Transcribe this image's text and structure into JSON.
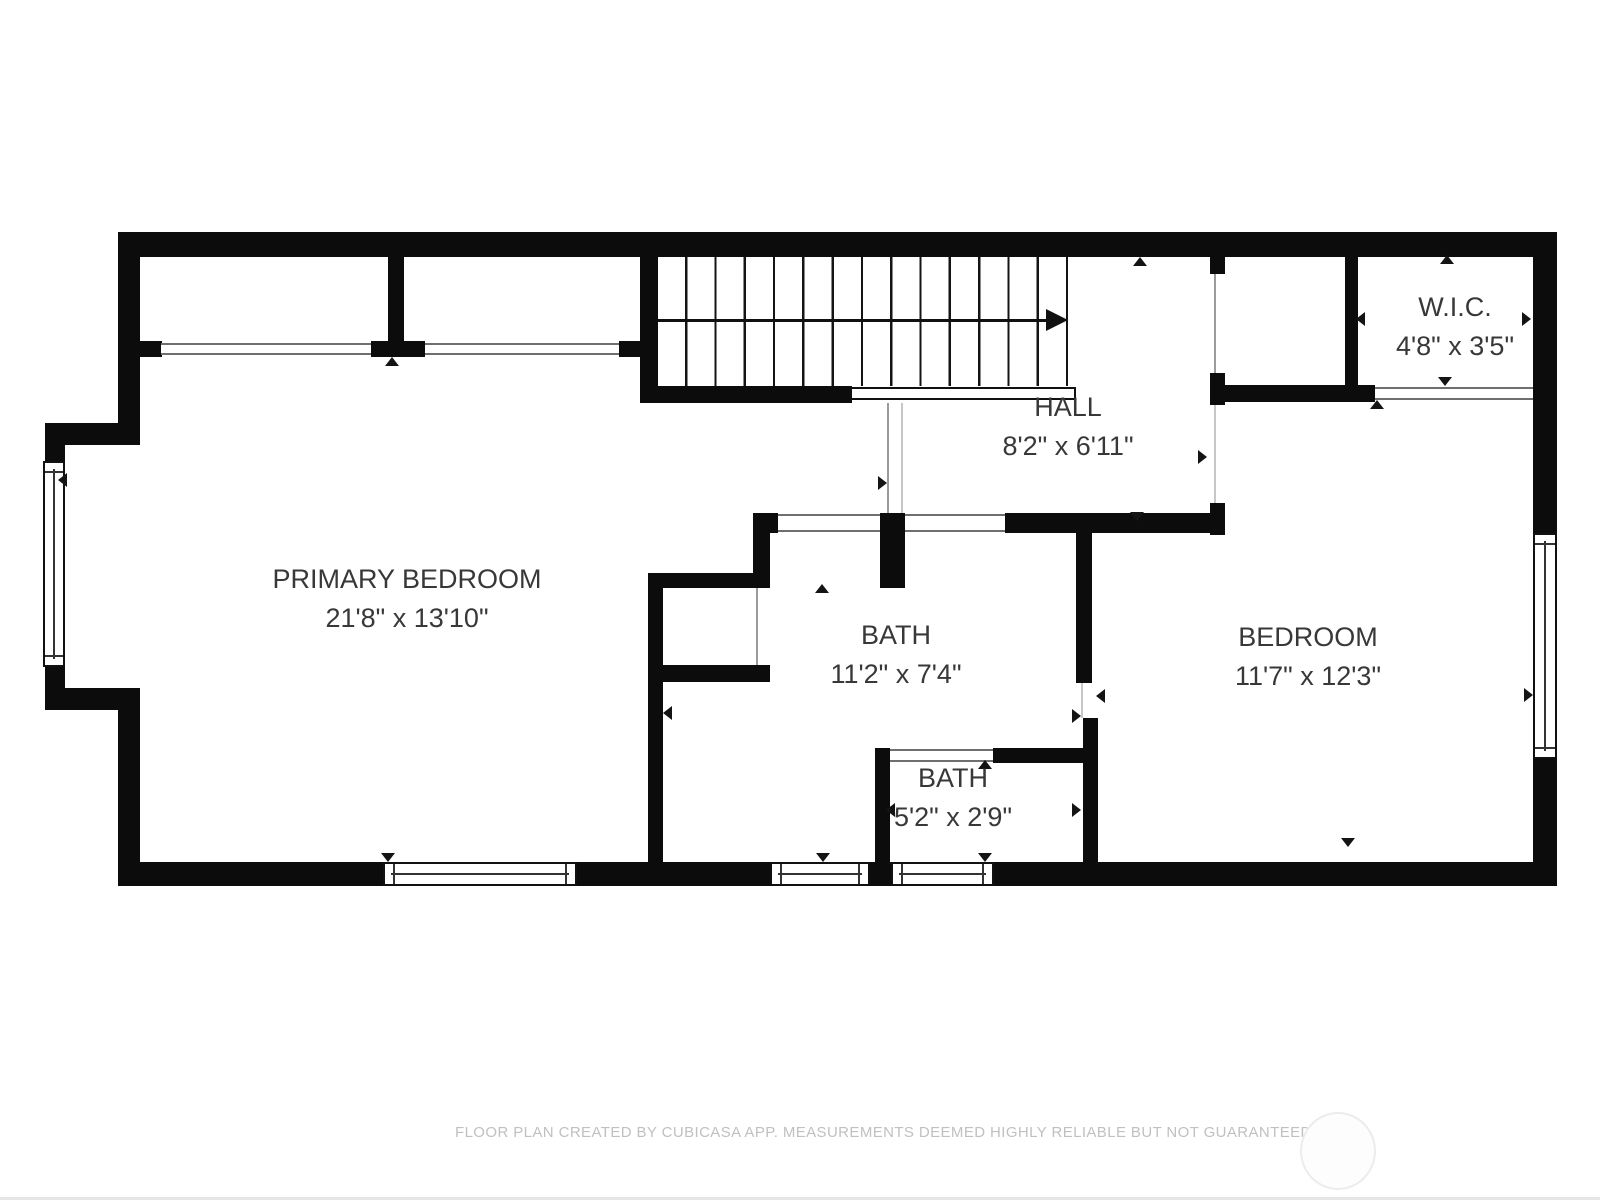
{
  "floor_plan": {
    "rooms": [
      {
        "name": "PRIMARY BEDROOM",
        "dims": "21'8\" x 13'10\""
      },
      {
        "name": "HALL",
        "dims": "8'2\" x 6'11\""
      },
      {
        "name": "W.I.C.",
        "dims": "4'8\" x 3'5\""
      },
      {
        "name": "BATH",
        "dims": "11'2\" x 7'4\""
      },
      {
        "name": "BATH",
        "dims": "5'2\" x 2'9\""
      },
      {
        "name": "BEDROOM",
        "dims": "11'7\" x 12'3\""
      }
    ],
    "footer_text": "FLOOR PLAN CREATED BY CUBICASA APP. MEASUREMENTS DEEMED HIGHLY RELIABLE BUT NOT GUARANTEED.",
    "colors": {
      "wall": "#0c0c0c",
      "label_text": "#383838",
      "footer_text": "#c0c0c0"
    }
  }
}
